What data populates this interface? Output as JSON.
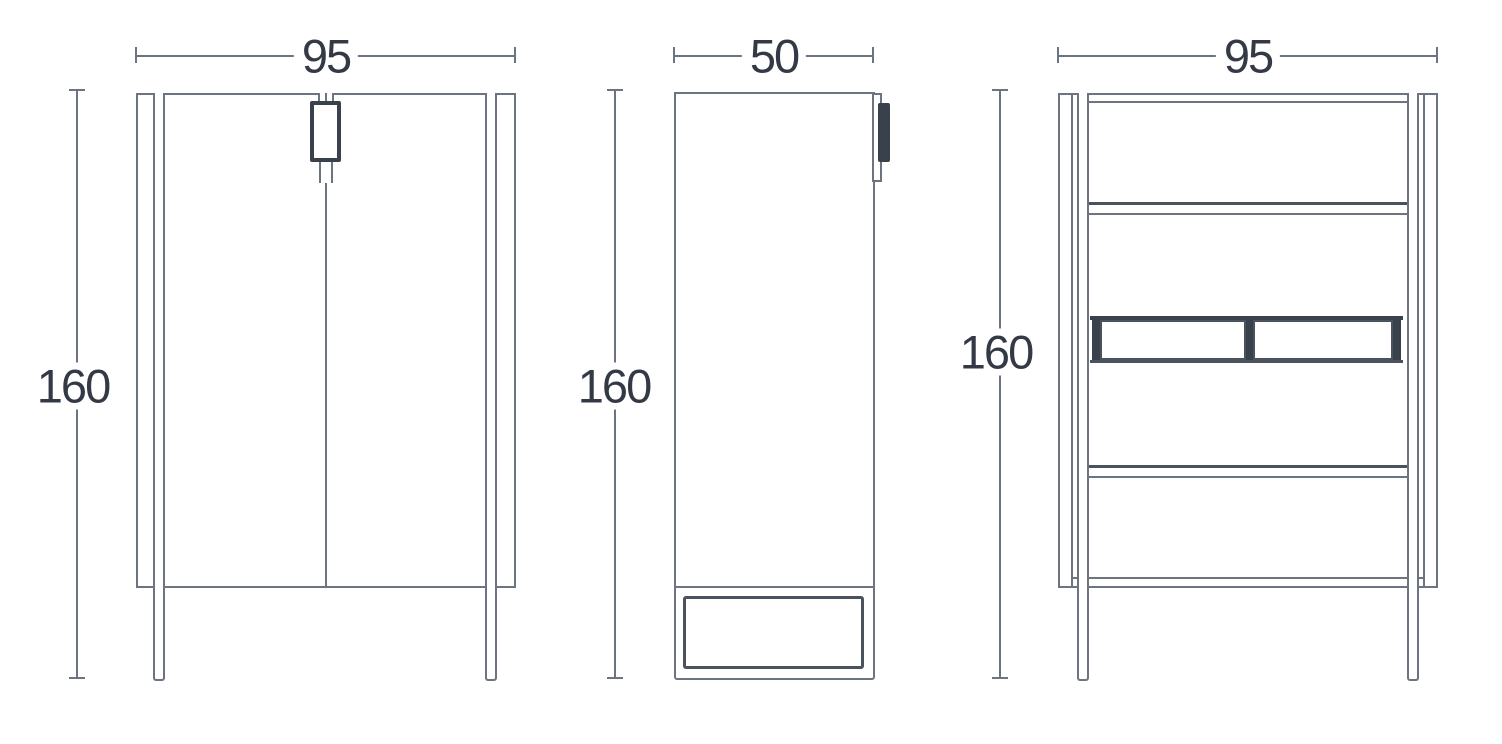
{
  "figure": {
    "kind": "furniture dimension drawing",
    "views": [
      {
        "id": "front",
        "width_label": "95",
        "height_label": "160"
      },
      {
        "id": "side",
        "width_label": "50",
        "height_label": "160"
      },
      {
        "id": "back",
        "width_label": "95",
        "height_label": "160"
      }
    ]
  },
  "colors": {
    "line": "#6b7480",
    "line_mid": "#4a525e",
    "line_dark": "#39414c",
    "text": "#333a45",
    "background": "#ffffff"
  }
}
